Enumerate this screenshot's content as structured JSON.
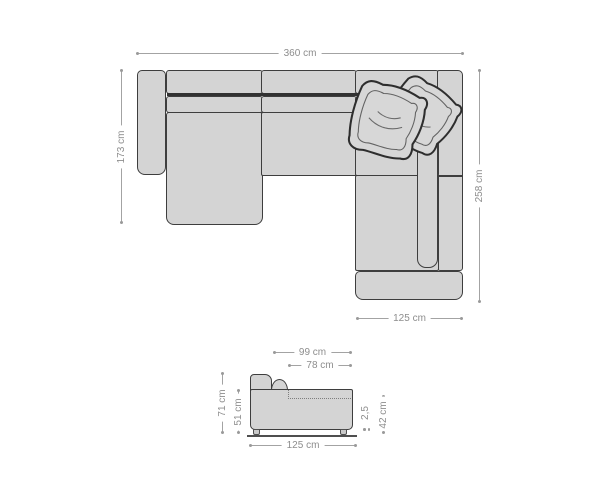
{
  "top_view": {
    "overall_width": "360 cm",
    "left_depth": "173 cm",
    "right_depth": "258 cm",
    "recamiere_width": "125 cm"
  },
  "side_view": {
    "depth_total": "99 cm",
    "seat_depth": "78 cm",
    "height_total": "71 cm",
    "body_height": "51 cm",
    "ground_clearance": "2,5",
    "seat_height": "42 cm",
    "length": "125 cm"
  },
  "icons": {
    "pillows": "two-throw-pillows"
  },
  "colors": {
    "sofa_fill": "#d4d4d4",
    "outline": "#3e3e3e",
    "dim_line": "#a3a3a3",
    "dim_dot": "#9a9a9a",
    "label_text": "#8d8d8d",
    "bg": "#ffffff"
  }
}
